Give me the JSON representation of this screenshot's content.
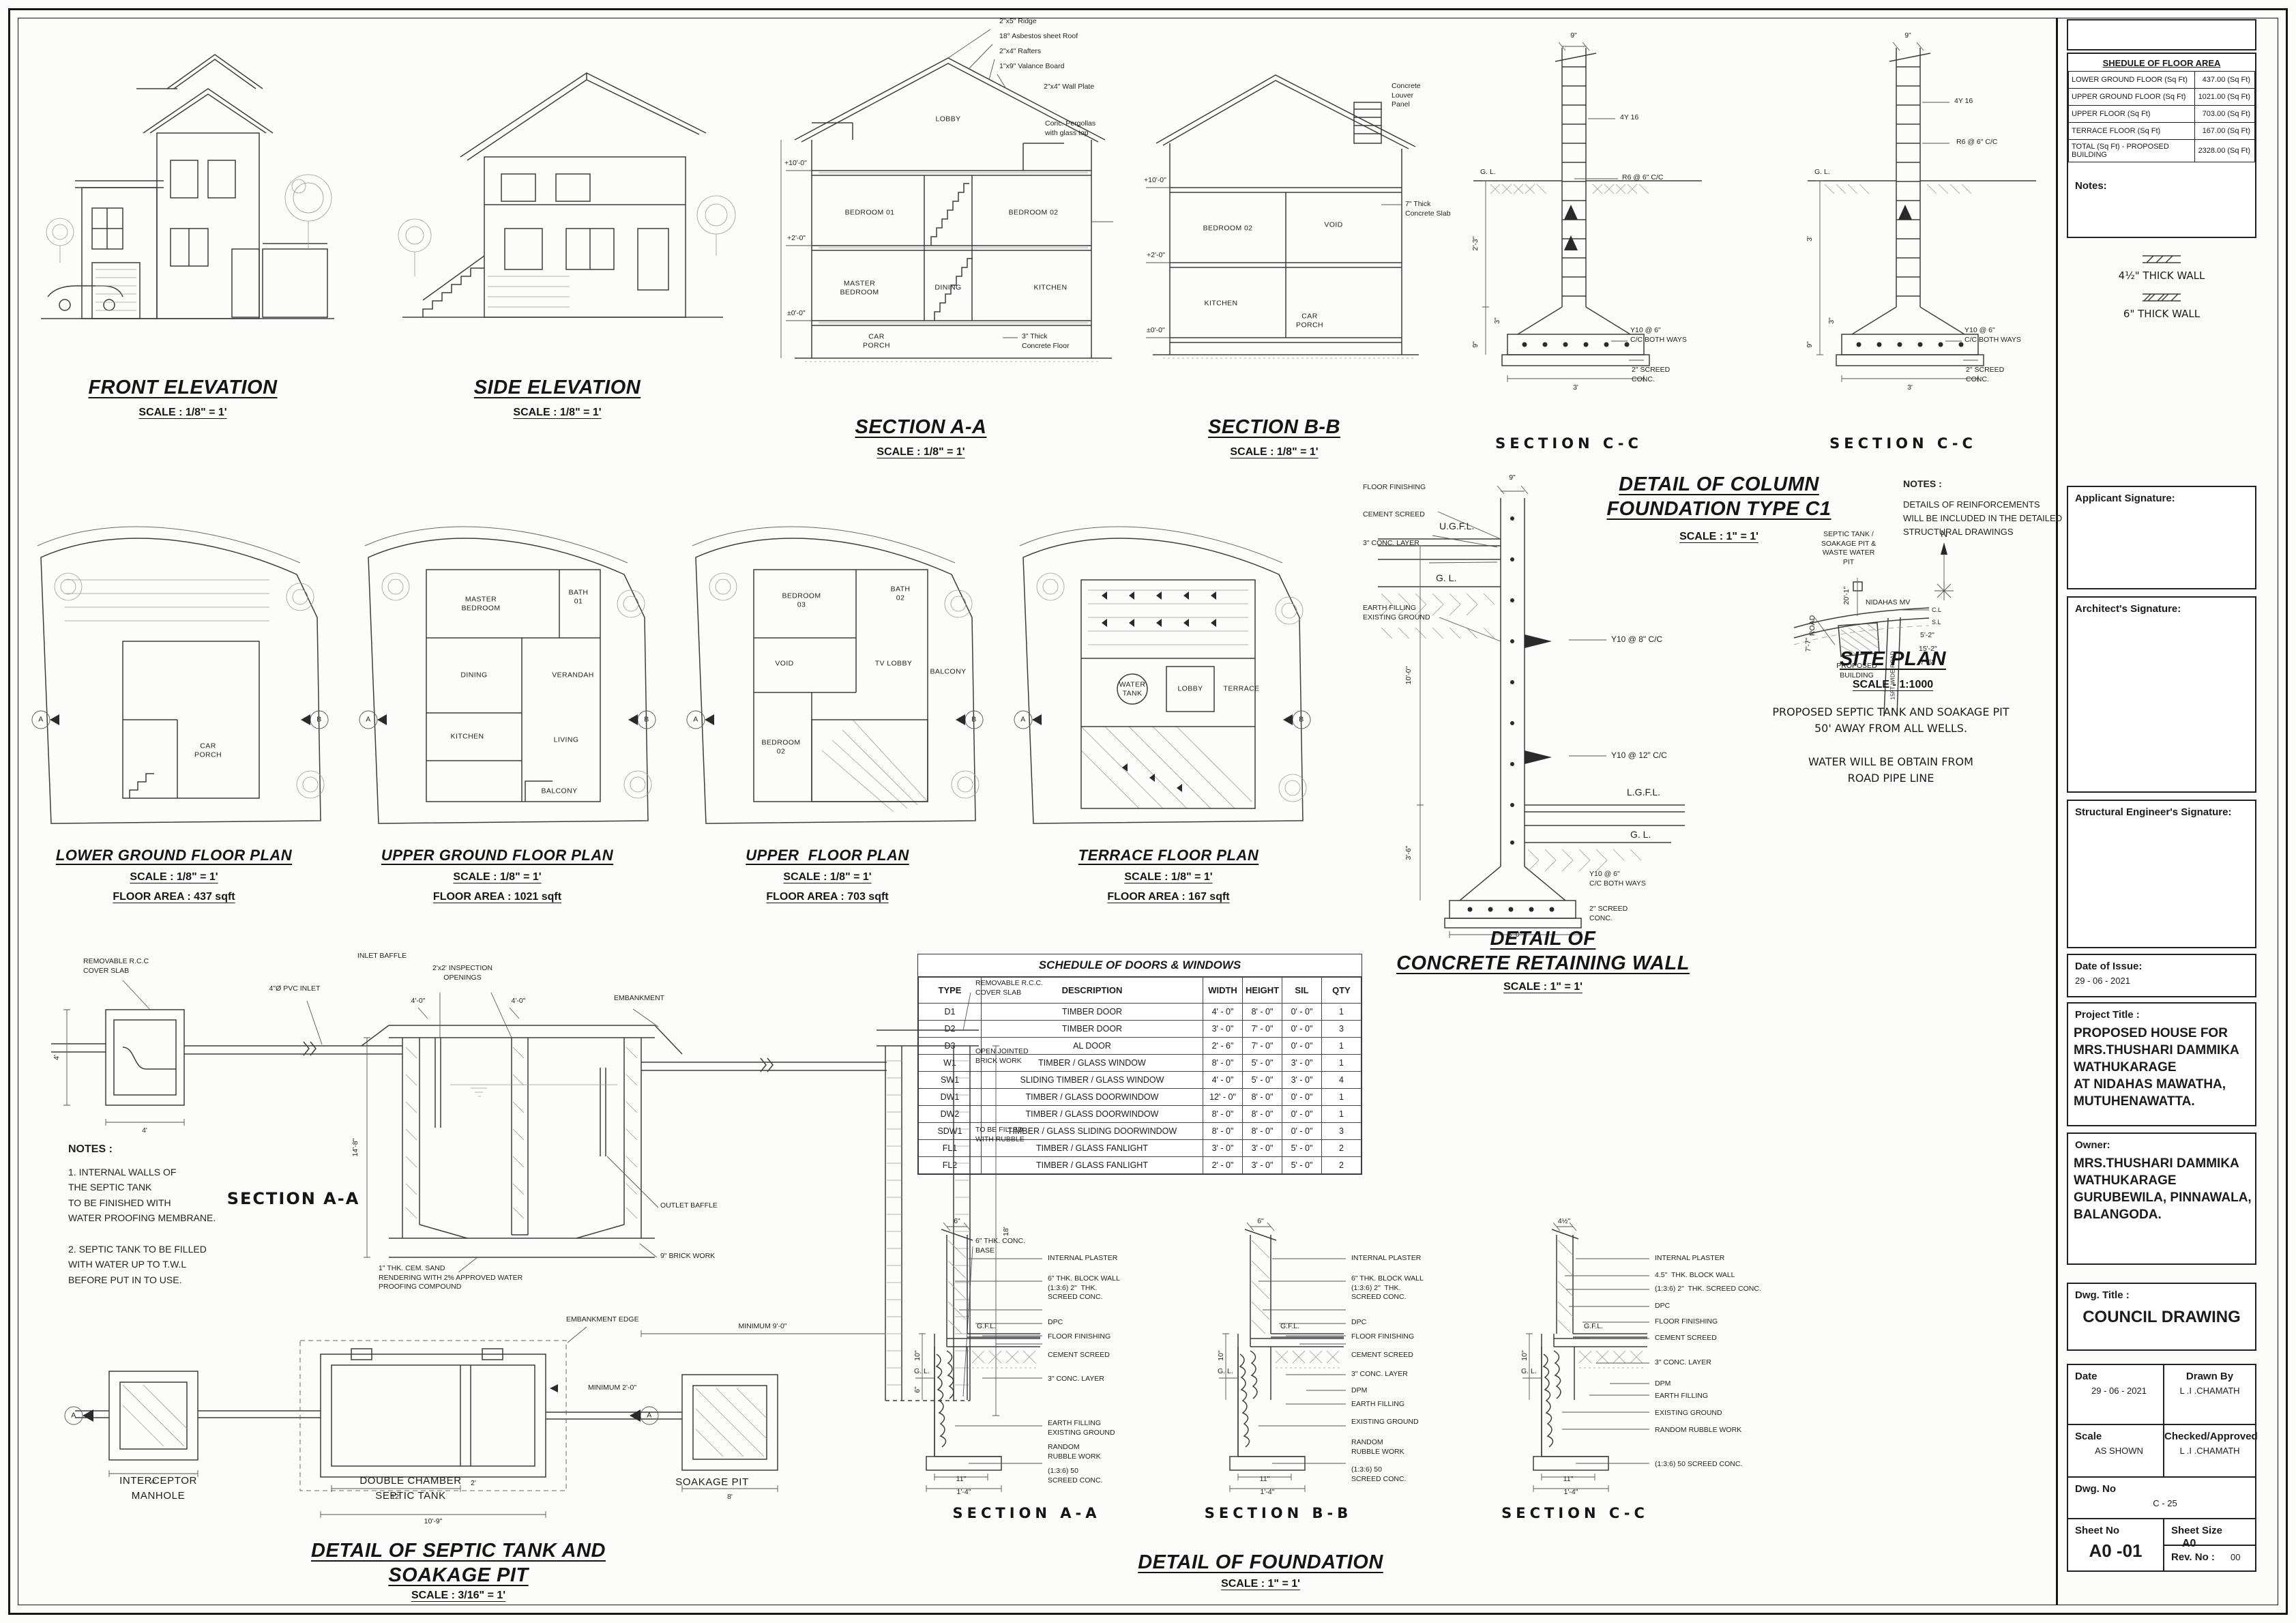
{
  "tb": {
    "fa_title": "SHEDULE OF FLOOR AREA",
    "fa": [
      [
        "LOWER GROUND FLOOR  (Sq Ft)",
        "437.00 (Sq Ft)"
      ],
      [
        "UPPER GROUND FLOOR  (Sq Ft)",
        "1021.00 (Sq Ft)"
      ],
      [
        "UPPER FLOOR  (Sq Ft)",
        "703.00 (Sq Ft)"
      ],
      [
        "TERRACE FLOOR  (Sq Ft)",
        "167.00 (Sq Ft)"
      ],
      [
        "TOTAL (Sq Ft) - PROPOSED BUILDING",
        "2328.00 (Sq Ft)"
      ]
    ],
    "notes": "Notes:",
    "legend_thin": "4½\" THICK WALL",
    "legend_thick": "6\" THICK WALL",
    "sig1": "Applicant Signature:",
    "sig2": "Architect's Signature:",
    "sig3": "Structural Engineer's Signature:",
    "issue_label": "Date of Issue:",
    "issue": "29 - 06 - 2021",
    "project_label": "Project Title :",
    "project": "PROPOSED HOUSE FOR\nMRS.THUSHARI DAMMIKA\nWATHUKARAGE\nAT NIDAHAS MAWATHA,\nMUTUHENAWATTA.",
    "owner_label": "Owner:",
    "owner": "MRS.THUSHARI DAMMIKA\nWATHUKARAGE\nGURUBEWILA, PINNAWALA,\nBALANGODA.",
    "dwg_label": "Dwg. Title :",
    "dwg": "COUNCIL DRAWING",
    "date_label": "Date",
    "date": "29 - 06 - 2021",
    "drawn_label": "Drawn By",
    "drawn": "L .I .CHAMATH",
    "scale_label": "Scale",
    "scale": "AS SHOWN",
    "chk_label": "Checked/Approved",
    "chk": "L .I .CHAMATH",
    "no_label": "Dwg. No",
    "no": "C - 25",
    "sheet_label": "Sheet No",
    "sheet": "A0 -01",
    "size_label": "Sheet Size",
    "size": "A0",
    "rev_label": "Rev. No :",
    "rev": "00"
  },
  "t": {
    "front": "FRONT ELEVATION",
    "side": "SIDE ELEVATION",
    "saa": "SECTION A-A",
    "sbb": "SECTION B-B",
    "scc": "SECTION C-C",
    "s18": "SCALE : 1/8\" = 1'",
    "s1": "SCALE : 1\" = 1'",
    "s316": "SCALE : 3/16\" = 1'",
    "s1000": "SCALE - 1:1000",
    "colf": "DETAIL OF COLUMN\nFOUNDATION TYPE C1",
    "ret": "DETAIL OF\nCONCRETE RETAINING WALL",
    "site": "SITE PLAN",
    "sepd": "DETAIL OF SEPTIC TANK AND\nSOAKAGE PIT",
    "fnd": "DETAIL OF FOUNDATION",
    "lg": "LOWER GROUND FLOOR PLAN",
    "ug": "UPPER GROUND FLOOR PLAN",
    "uf": "UPPER  FLOOR PLAN",
    "tr": "TERRACE FLOOR PLAN",
    "lga": "FLOOR AREA : 437 sqft",
    "uga": "FLOOR AREA : 1021 sqft",
    "ufa": "FLOOR AREA : 703 sqft",
    "tra": "FLOOR AREA : 167 sqft"
  },
  "sec": {
    "ridge": "2\"x5\" Ridge",
    "roof": "18° Asbestos sheet Roof",
    "raft": "2\"x4\" Rafters",
    "val": "1\"x9\" Valance Board",
    "wp": "2\"x4\" Wall Plate",
    "perg": "Conc. Pergollas\nwith glass top",
    "slab7": "7\" Thick\nConcrete Slab",
    "floor3": "3\" Thick\nConcrete Floor",
    "louver": "Concrete\nLouver\nPanel",
    "lobby": "LOBBY",
    "bed1": "BEDROOM 01",
    "bed2": "BEDROOM 02",
    "master": "MASTER\nBEDROOM",
    "dining": "DINING",
    "kitchen": "KITCHEN",
    "car": "CAR\nPORCH",
    "void": "VOID",
    "lv2": "+2'-0\"",
    "lv10": "+10'-0\"",
    "lv0": "±0'-0\""
  },
  "cf": {
    "d9": "9\"",
    "bars": "4Y 16",
    "st": "R6 @ 6\" C/C",
    "gl": "G. L.",
    "d23": "2'-3\"",
    "d3ft": "3'",
    "d3": "3\"",
    "d9b": "9\"",
    "mesh": "Y10 @ 6\"\nC/C BOTH WAYS",
    "scr": "2\" SCREED\nCONC.",
    "w3": "3'",
    "notes_label": "NOTES :",
    "notes": "DETAILS OF REINFORCEMENTS\nWILL BE INCLUDED IN THE DETAILED\nSTRUCTURAL DRAWINGS"
  },
  "pl": {
    "a": "A",
    "b": "B",
    "car": "CAR\nPORCH",
    "master": "MASTER\nBEDROOM",
    "bath1": "BATH\n01",
    "dining": "DINING",
    "ver": "VERANDAH",
    "kit": "KITCHEN",
    "liv": "LIVING",
    "bal": "BALCONY",
    "bed3": "BEDROOM\n03",
    "bath2": "BATH\n02",
    "void": "VOID",
    "tv": "TV LOBBY",
    "bed2": "BEDROOM\n02",
    "ter": "TERRACE",
    "lobby": "LOBBY",
    "wt": "WATER\nTANK"
  },
  "rw": {
    "ff": "FLOOR FINISHING",
    "cs": "CEMENT SCREED",
    "cl": "3\" CONC. LAYER",
    "ef": "EARTH FILLING\nEXISTING GROUND",
    "ugfl": "U.G.F.L.",
    "gl": "G. L.",
    "d9": "9\"",
    "y8": "Y10 @ 8\" C/C",
    "y12": "Y10 @ 12\" C/C",
    "lgfl": "L.G.F.L.",
    "gl2": "G. L.",
    "d10": "10'-0\"",
    "d36": "3'-6\"",
    "y6": "Y10 @ 6\"\nC/C BOTH WAYS",
    "scr": "2\" SCREED\nCONC.",
    "d60": "6'-0\""
  },
  "si": {
    "sep": "SEPTIC TANK /\nSOAKAGE PIT &\nWASTE WATER\nPIT",
    "n": "N",
    "road": "NIDAHAS MV",
    "cl": "C.L",
    "sl": "S.L",
    "rd": "ROAD",
    "wide": "15FT WIDE ROAD",
    "d1": "20'-1\"",
    "d2": "5'-2\"",
    "d3": "15'-2\"",
    "d4": "7'-6\"",
    "d5": "7'-7\"",
    "bldg": "PROPOSED\nBUILDING",
    "note1": "PROPOSED SEPTIC TANK AND SOAKAGE PIT\n50' AWAY FROM ALL WELLS.",
    "note2": "WATER WILL BE OBTAIN FROM\nROAD PIPE LINE"
  },
  "sch": {
    "title": "SCHEDULE OF DOORS & WINDOWS",
    "h": [
      "TYPE",
      "DESCRIPTION",
      "WIDTH",
      "HEIGHT",
      "SIL",
      "QTY"
    ],
    "r": [
      [
        "D1",
        "TIMBER DOOR",
        "4' - 0\"",
        "8' - 0\"",
        "0' - 0\"",
        "1"
      ],
      [
        "D2",
        "TIMBER DOOR",
        "3' - 0\"",
        "7' - 0\"",
        "0' - 0\"",
        "3"
      ],
      [
        "D3",
        "AL DOOR",
        "2' - 6\"",
        "7' - 0\"",
        "0' - 0\"",
        "1"
      ],
      [
        "W1",
        "TIMBER / GLASS WINDOW",
        "8' - 0\"",
        "5' - 0\"",
        "3' - 0\"",
        "1"
      ],
      [
        "SW1",
        "SLIDING TIMBER / GLASS WINDOW",
        "4' - 0\"",
        "5' - 0\"",
        "3' - 0\"",
        "4"
      ],
      [
        "DW1",
        "TIMBER / GLASS DOORWINDOW",
        "12' - 0\"",
        "8' - 0\"",
        "0' - 0\"",
        "1"
      ],
      [
        "DW2",
        "TIMBER / GLASS DOORWINDOW",
        "8' - 0\"",
        "8' - 0\"",
        "0' - 0\"",
        "1"
      ],
      [
        "SDW1",
        "TIMBER / GLASS SLIDING DOORWINDOW",
        "8' - 0\"",
        "8' - 0\"",
        "0' - 0\"",
        "3"
      ],
      [
        "FL1",
        "TIMBER / GLASS FANLIGHT",
        "3' - 0\"",
        "3' - 0\"",
        "5' - 0\"",
        "2"
      ],
      [
        "FL2",
        "TIMBER / GLASS FANLIGHT",
        "2' - 0\"",
        "3' - 0\"",
        "5' - 0\"",
        "2"
      ]
    ]
  },
  "sp": {
    "rcc": "REMOVABLE R.C.C\nCOVER SLAB",
    "rcc2": "REMOVABLE R.C.C.\nCOVER SLAB",
    "inlet": "4\"Ø PVC INLET",
    "insp": "2'x2' INSPECTION\nOPENINGS",
    "d40": "4'-0\"",
    "emb": "EMBANKMENT",
    "ib": "INLET BAFFLE",
    "ob": "OUTLET BAFFLE",
    "bw": "9\" BRICK WORK",
    "open": "OPEN JOINTED\nBRICK WORK",
    "fill": "TO BE FILLED\nWITH RUBBLE",
    "base": "6\" THK. CONC.\nBASE",
    "min9": "MINIMUM 9'-0\"",
    "rend": "1\" THK. CEM. SAND\nRENDERING WITH 2% APPROVED WATER\nPROOFING COMPOUND",
    "d148": "14'-8\"",
    "d4": "4'",
    "d18": "18'",
    "d8": "8'",
    "d12": "12'",
    "d2": "2'",
    "d109": "10'-9\"",
    "min2": "MINIMUM 2'-0\"",
    "edge": "EMBANKMENT EDGE",
    "a": "A",
    "saa": "SECTION A-A",
    "notes_label": "NOTES :",
    "n1": "1. INTERNAL WALLS OF\nTHE SEPTIC TANK\nTO BE FINISHED WITH\nWATER PROOFING MEMBRANE.",
    "n2": "2. SEPTIC TANK TO BE FILLED\nWITH WATER UP TO T.W.L\nBEFORE PUT IN TO USE.",
    "im": "INTERCEPTOR\nMANHOLE",
    "dc": "DOUBLE CHAMBER\nSEPTIC TANK",
    "sk": "SOAKAGE PIT"
  },
  "fn": {
    "aa": "SECTION A-A",
    "bb": "SECTION B-B",
    "cc": "SECTION C-C",
    "d6": "6\"",
    "d45": "4½\"",
    "gfl": "G.F.L.",
    "gl": "G. L.",
    "d10": "10\"",
    "d11": "11\"",
    "d14": "1'-4\"",
    "c1": "INTERNAL PLASTER",
    "c2": "6\" THK. BLOCK WALL\n(1:3:6) 2\"  THK.\nSCREED CONC.",
    "c2c": "4.5\"  THK. BLOCK WALL",
    "c2c2": "(1:3:6) 2\"  THK. SCREED CONC.",
    "dpc": "DPC",
    "ff": "FLOOR FINISHING",
    "cs": "CEMENT SCREED",
    "cl": "3\" CONC. LAYER",
    "dpm": "DPM",
    "ef": "EARTH FILLING\nEXISTING GROUND",
    "ef2": "EARTH FILLING",
    "eg": "EXISTING GROUND",
    "rr": "RANDOM\nRUBBLE WORK",
    "rr2": "RANDOM RUBBLE WORK",
    "sc": "(1:3:6) 50\nSCREED CONC.",
    "sc2": "(1:3:6) 50 SCREED CONC."
  }
}
